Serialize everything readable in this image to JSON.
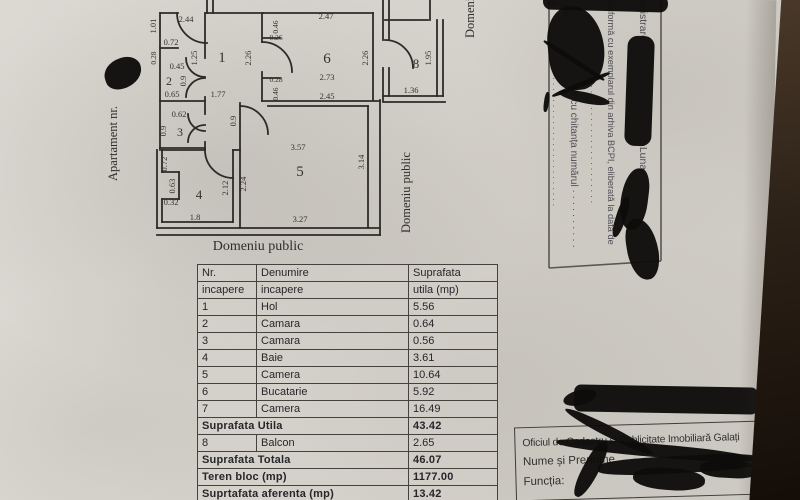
{
  "texts": [
    {
      "n": "apartment-number-label",
      "t": "Apartament nr.",
      "x": 117,
      "y": 181,
      "rot": -90,
      "s": 12.5
    },
    {
      "n": "public-domain-bottom-label",
      "t": "Domeniu public",
      "x": 258,
      "y": 250,
      "s": 14,
      "anchor": "middle"
    },
    {
      "n": "public-domain-right-label",
      "t": "Domeniu public",
      "x": 410,
      "y": 233,
      "rot": -90,
      "s": 12.5
    },
    {
      "n": "public-domain-top-label",
      "t": "Domeniu public",
      "x": 474,
      "y": 38,
      "rot": -90,
      "s": 12.5
    }
  ],
  "plan": {
    "labels": [
      {
        "t": "2.44",
        "x": 186,
        "y": 22
      },
      {
        "t": "1.01",
        "x": 156,
        "y": 26,
        "r": 1
      },
      {
        "t": "0.72",
        "x": 171,
        "y": 45
      },
      {
        "t": "1.25",
        "x": 197,
        "y": 58,
        "r": 1
      },
      {
        "t": "1",
        "x": 222,
        "y": 62,
        "s": 15
      },
      {
        "t": "2.26",
        "x": 251,
        "y": 58,
        "r": 1
      },
      {
        "t": "1.77",
        "x": 218,
        "y": 97
      },
      {
        "t": "0.28",
        "x": 156,
        "y": 58,
        "r": 1,
        "s": 7.5
      },
      {
        "t": "0.45",
        "x": 177,
        "y": 69
      },
      {
        "t": "2",
        "x": 169,
        "y": 85,
        "s": 12
      },
      {
        "t": "0.9",
        "x": 186,
        "y": 81,
        "r": 1
      },
      {
        "t": "0.65",
        "x": 172,
        "y": 97
      },
      {
        "t": "0.62",
        "x": 179,
        "y": 117
      },
      {
        "t": "0.9",
        "x": 166,
        "y": 131,
        "r": 1
      },
      {
        "t": "3",
        "x": 180,
        "y": 136,
        "s": 12
      },
      {
        "t": "0.72",
        "x": 167,
        "y": 164,
        "r": 1
      },
      {
        "t": "0.63",
        "x": 175,
        "y": 186,
        "r": 1
      },
      {
        "t": "0.32",
        "x": 171,
        "y": 205
      },
      {
        "t": "4",
        "x": 199,
        "y": 199,
        "s": 13
      },
      {
        "t": "1.8",
        "x": 195,
        "y": 220
      },
      {
        "t": "2.12",
        "x": 228,
        "y": 188,
        "r": 1
      },
      {
        "t": "2.24",
        "x": 246,
        "y": 184,
        "r": 1
      },
      {
        "t": "0.9",
        "x": 236,
        "y": 121,
        "r": 1
      },
      {
        "t": "3.57",
        "x": 298,
        "y": 150
      },
      {
        "t": "5",
        "x": 300,
        "y": 176,
        "s": 15
      },
      {
        "t": "3.27",
        "x": 300,
        "y": 222
      },
      {
        "t": "3.14",
        "x": 364,
        "y": 162,
        "r": 1
      },
      {
        "t": "0.46",
        "x": 278,
        "y": 27,
        "r": 1,
        "s": 7.5
      },
      {
        "t": "0.26",
        "x": 276,
        "y": 40,
        "s": 7.5
      },
      {
        "t": "2.47",
        "x": 326,
        "y": 19
      },
      {
        "t": "6",
        "x": 327,
        "y": 63,
        "s": 15
      },
      {
        "t": "2.73",
        "x": 327,
        "y": 80
      },
      {
        "t": "2.26",
        "x": 368,
        "y": 58,
        "r": 1
      },
      {
        "t": "0.28",
        "x": 276,
        "y": 82,
        "s": 7.5
      },
      {
        "t": "0.46",
        "x": 278,
        "y": 94,
        "r": 1,
        "s": 7.5
      },
      {
        "t": "2.45",
        "x": 327,
        "y": 99
      },
      {
        "t": "8",
        "x": 416,
        "y": 68,
        "s": 13
      },
      {
        "t": "1.95",
        "x": 431,
        "y": 58,
        "r": 1
      },
      {
        "t": "1.36",
        "x": 411,
        "y": 93
      }
    ]
  },
  "stamp": {
    "lines": [
      {
        "t": "egistrare",
        "x": 640,
        "y": 0,
        "s": 10.5
      },
      {
        "t": ", Luna",
        "x": 640,
        "y": 141,
        "s": 10.5
      },
      {
        "t": "· · · · · · · · · · · · · ·",
        "x": 640,
        "y": 176,
        "s": 9.5
      },
      {
        "t": "conformă cu exemplarul din arhiva BCPI, eliberată la data de",
        "x": 608,
        "y": -3,
        "s": 9.2
      },
      {
        "t": "· · · · · · · · · · · · · · · · · · · · · · · · · · · · · · · ·",
        "x": 589,
        "y": 30,
        "s": 9
      },
      {
        "t": "X cu chitanța numărul · · · · · · · · · ·",
        "x": 571,
        "y": 90,
        "s": 10
      },
      {
        "t": "ul.",
        "x": 552,
        "y": -2,
        "s": 9
      },
      {
        "t": "ent.",
        "x": 563,
        "y": 4,
        "s": 9
      },
      {
        "t": "· · · · · · · · · · · · · · · · · · · · · · · · · · · ·",
        "x": 551,
        "y": 55,
        "s": 9
      }
    ]
  },
  "table": {
    "header": [
      [
        "Nr.",
        "Denumire",
        "Suprafata"
      ],
      [
        "incapere",
        "incapere",
        "utila (mp)"
      ]
    ],
    "rows": [
      {
        "kind": "data",
        "nr": "1",
        "name": "Hol",
        "value": "5.56"
      },
      {
        "kind": "data",
        "nr": "2",
        "name": "Camara",
        "value": "0.64"
      },
      {
        "kind": "data",
        "nr": "3",
        "name": "Camara",
        "value": "0.56"
      },
      {
        "kind": "data",
        "nr": "4",
        "name": "Baie",
        "value": "3.61"
      },
      {
        "kind": "data",
        "nr": "5",
        "name": "Camera",
        "value": "10.64"
      },
      {
        "kind": "data",
        "nr": "6",
        "name": "Bucatarie",
        "value": "5.92"
      },
      {
        "kind": "data",
        "nr": "7",
        "name": "Camera",
        "value": "16.49"
      },
      {
        "kind": "summary",
        "label": "Suprafata Utila",
        "value": "43.42"
      },
      {
        "kind": "data",
        "nr": "8",
        "name": "Balcon",
        "value": "2.65"
      },
      {
        "kind": "summary",
        "label": "Suprafata Totala",
        "value": "46.07"
      },
      {
        "kind": "summary",
        "label": "Teren bloc (mp)",
        "value": "1177.00"
      },
      {
        "kind": "summary",
        "label": "Suprtafata aferenta (mp)",
        "value": "13.42"
      },
      {
        "kind": "summary",
        "label": "Cota Indiviza (%)",
        "value": "1.14"
      }
    ]
  },
  "office_box": {
    "line1": "Oficiul de Cadastru și Publicitate Imobiliară Galați",
    "line2": "Nume și Prenume",
    "line3": "Funcția:"
  }
}
